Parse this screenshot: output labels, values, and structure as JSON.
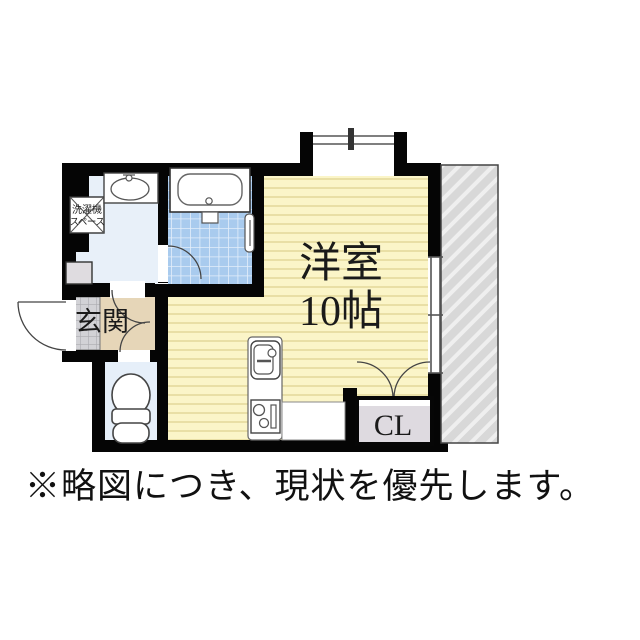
{
  "plan": {
    "room_label": {
      "line1": "洋室",
      "line2": "10帖"
    },
    "closet_label": "CL",
    "entrance_label": "玄関",
    "laundry_label": {
      "line1": "洗濯機",
      "line2": "スペース"
    }
  },
  "note": "※略図につき、現状を優先します。",
  "colors": {
    "wall": "#000000",
    "room_floor": "#FBF5C8",
    "room_stripe": "#E9DFA5",
    "bath_tile": "#A9CBEE",
    "washroom_floor": "#E8F0F9",
    "toilet_floor": "#E6EFF9",
    "hall_floor": "#E6D6B8",
    "entrance_tile": "#D2D2D6",
    "closet_fill": "#DEDAE0",
    "hatch_fill": "#D8D8D8"
  }
}
